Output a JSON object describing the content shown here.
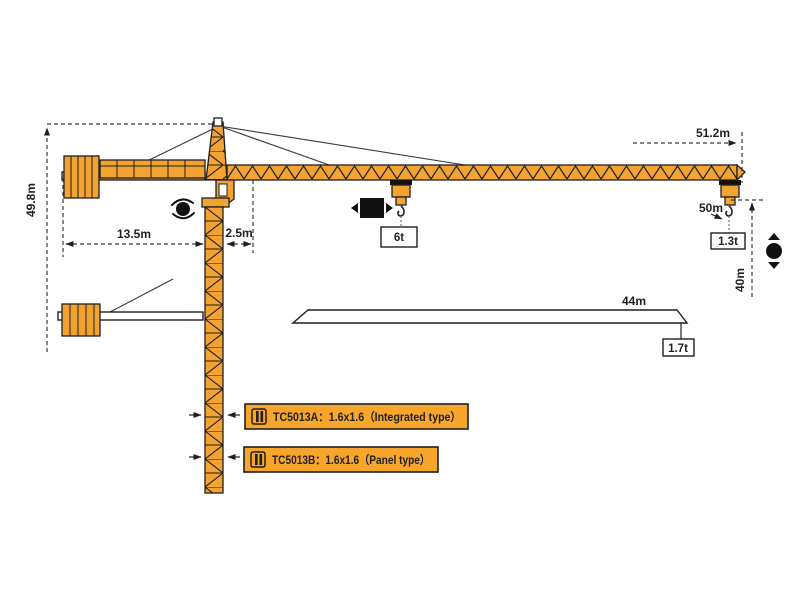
{
  "title": "TC5013 tower crane working-range diagram",
  "colors": {
    "crane_orange": "#F2A332",
    "spec_box_fill": "#F7A62B",
    "outline": "#1f1f1f",
    "background": "#ffffff"
  },
  "dimensions": {
    "total_height": "49.8m",
    "counter_jib_length": "13.5m",
    "tower_offset": "2.5m",
    "max_jib_radius": "51.2m",
    "trolley_radius": "50m",
    "hook_height": "40m",
    "short_jib_length": "44m"
  },
  "loads": {
    "max_load": "6t",
    "tip_load_50m": "1.3t",
    "tip_load_44m": "1.7t"
  },
  "spec_boxes": [
    {
      "text": "TC5013A：1.6x1.6（Integrated type）"
    },
    {
      "text": "TC5013B：1.6x1.6（Panel type）"
    }
  ],
  "icons": {
    "slewing": "slewing-rotation-indicator",
    "trolley": "trolley-travel-indicator",
    "hoist": "hoist-up-down-indicator",
    "mast_section": "mast-cross-section-symbol"
  }
}
